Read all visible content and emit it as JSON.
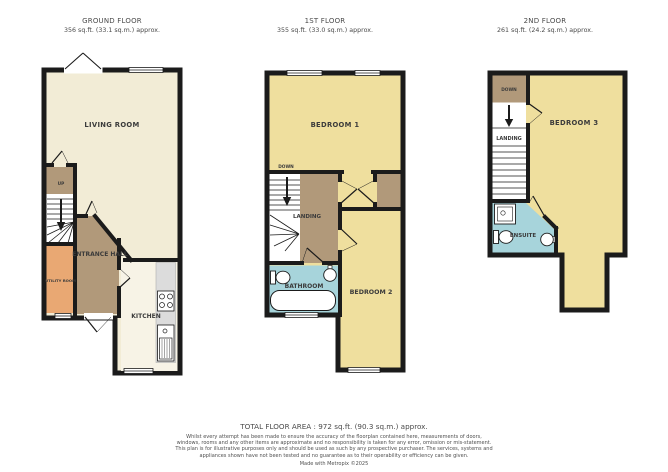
{
  "floors": [
    {
      "name": "GROUND FLOOR",
      "area": "356 sq.ft. (33.1 sq.m.) approx.",
      "rooms": {
        "living": "LIVING ROOM",
        "hall": "ENTRANCE HALL",
        "utility": "UTILITY ROOM",
        "kitchen": "KITCHEN",
        "up": "UP"
      }
    },
    {
      "name": "1ST FLOOR",
      "area": "355 sq.ft. (33.0 sq.m.) approx.",
      "rooms": {
        "bedroom1": "BEDROOM 1",
        "down": "DOWN",
        "landing": "LANDING",
        "bathroom": "BATHROOM",
        "bedroom2": "BEDROOM 2"
      }
    },
    {
      "name": "2ND FLOOR",
      "area": "261 sq.ft. (24.2 sq.m.) approx.",
      "rooms": {
        "bedroom3": "BEDROOM 3",
        "down": "DOWN",
        "landing": "LANDING",
        "ensuite": "ENSUITE"
      }
    }
  ],
  "footer": {
    "total_area": "TOTAL FLOOR AREA : 972 sq.ft. (90.3 sq.m.) approx.",
    "disclaimer": "Whilst every attempt has been made to ensure the accuracy of the floorplan contained here, measurements of doors, windows, rooms and any other items are approximate and no responsibility is taken for any error, omission or mis-statement. This plan is for illustrative purposes only and should be used as such by any prospective purchaser. The services, systems and appliances shown have not been tested and no guarantee as to their operability or efficiency can be given.",
    "credit": "Made with Metropix ©2025"
  },
  "colors": {
    "wall": "#1b1b1b",
    "living_cream": "#F2ECD6",
    "kitchen_cream": "#F7F3E6",
    "bedroom_yellow": "#EFDF9E",
    "hall_brown": "#B1997A",
    "utility_orange": "#E9A873",
    "bath_blue": "#A7D4DB",
    "counter_gray": "#DCDCDC"
  }
}
